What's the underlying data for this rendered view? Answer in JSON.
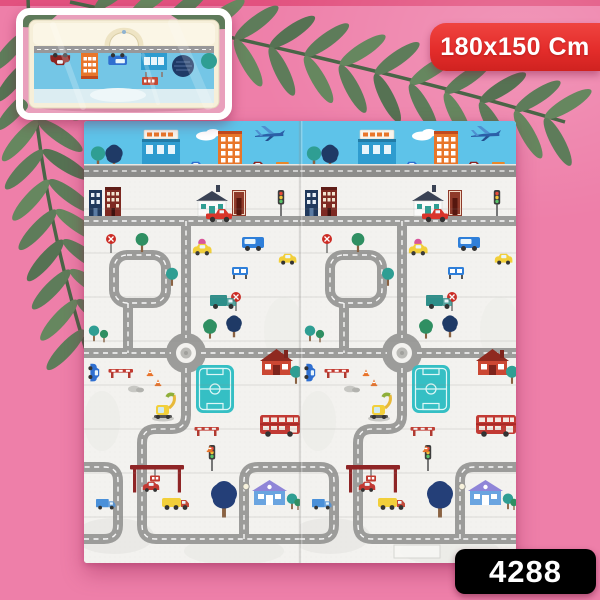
{
  "page": {
    "background_color": "#ee7fa9",
    "top_edge_color": "#e2517f"
  },
  "size_ribbon": {
    "label": "180x150 Cm",
    "background_color": "#e42d2b",
    "fold_color": "#8f1412",
    "text_color": "#ffffff"
  },
  "product_code_badge": {
    "label": "4288",
    "background_color": "#000000",
    "text_color": "#ffffff"
  },
  "inset_photo": {
    "content": "folded-playmat-in-clear-carry-bag-with-handle"
  },
  "play_mat": {
    "panel_count": 2,
    "colors": {
      "sky": "#5ec3e9",
      "surface": "#f3f2ef",
      "road": "#9c9c9a",
      "road_dash": "#ffffff",
      "field": "#35bfc4"
    },
    "scene_elements": [
      "airplane",
      "cloud",
      "city-skyline-buildings",
      "cars",
      "trucks",
      "double-decker-bus",
      "excavator",
      "gas-station",
      "roundabout",
      "road-maze",
      "sports-field",
      "houses",
      "trees",
      "traffic-lights",
      "stop-signs",
      "traffic-cones",
      "barriers",
      "street-lamp"
    ]
  },
  "decor": {
    "leaf_color": "#5e7c5a"
  }
}
